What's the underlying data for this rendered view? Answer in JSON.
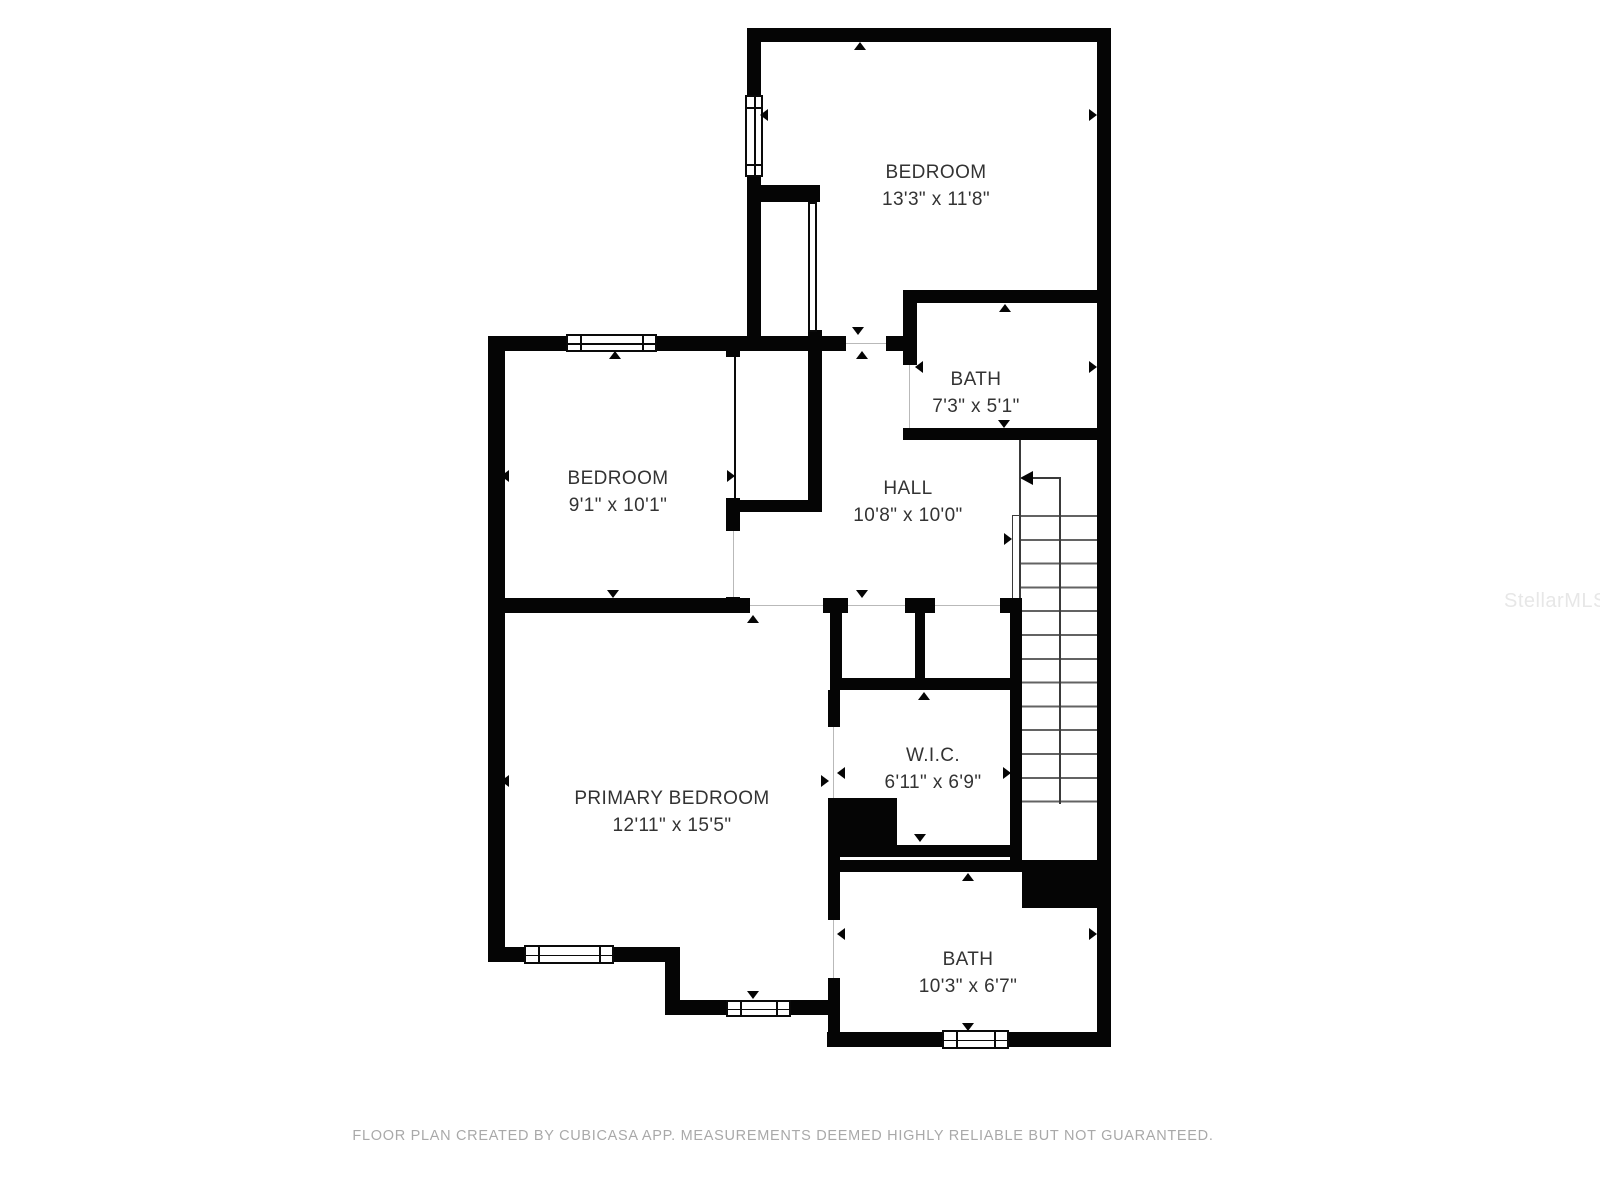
{
  "plan": {
    "creator_note": "FLOOR PLAN CREATED BY CUBICASA APP. MEASUREMENTS DEEMED HIGHLY RELIABLE BUT NOT GUARANTEED.",
    "watermark": "StellarMLS"
  },
  "rooms": [
    {
      "name": "BEDROOM",
      "dims": "13'3\" x 11'8\""
    },
    {
      "name": "BATH",
      "dims": "7'3\" x 5'1\""
    },
    {
      "name": "BEDROOM",
      "dims": "9'1\" x 10'1\""
    },
    {
      "name": "HALL",
      "dims": "10'8\" x 10'0\""
    },
    {
      "name": "PRIMARY BEDROOM",
      "dims": "12'11\" x 15'5\""
    },
    {
      "name": "W.I.C.",
      "dims": "6'11\" x 6'9\""
    },
    {
      "name": "BATH",
      "dims": "10'3\" x 6'7\""
    }
  ],
  "colors": {
    "wall": "#050505",
    "room_text": "#333333",
    "disclaimer_text": "#a9a9a9",
    "watermark_text": "#e7e7e7",
    "background": "#ffffff"
  }
}
